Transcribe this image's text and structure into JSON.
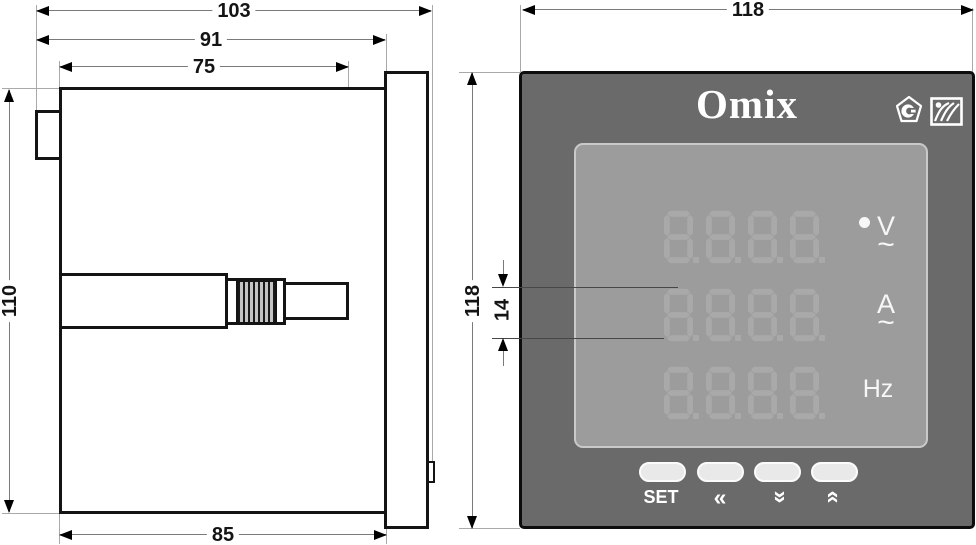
{
  "drawing": {
    "side_view": {
      "dimensions": {
        "total_depth": "103",
        "depth_behind_bezel": "91",
        "bracket_length": "75",
        "body_height": "110",
        "body_depth": "85"
      }
    },
    "front_view": {
      "brand": "Omix",
      "dimensions": {
        "panel_width": "118",
        "panel_height": "118",
        "digit_height": "14"
      },
      "display_rows": [
        {
          "digits": "8888",
          "unit": "V",
          "ac_mark": "~"
        },
        {
          "digits": "8888",
          "unit": "A",
          "ac_mark": "~"
        },
        {
          "digits": "8888",
          "unit": "Hz"
        }
      ],
      "buttons": [
        {
          "name": "set",
          "label": "SET"
        },
        {
          "name": "shift-left",
          "label": "«"
        },
        {
          "name": "down",
          "label": "«"
        },
        {
          "name": "up",
          "label": "«"
        }
      ],
      "icons": [
        "certification-pentagon-icon",
        "quality-mark-square-icon"
      ],
      "colors": {
        "panel": "#6a6a6a",
        "display_bg": "#9c9c9c",
        "segments": "#a9a9a9",
        "accent_text": "#ffffff"
      }
    }
  }
}
